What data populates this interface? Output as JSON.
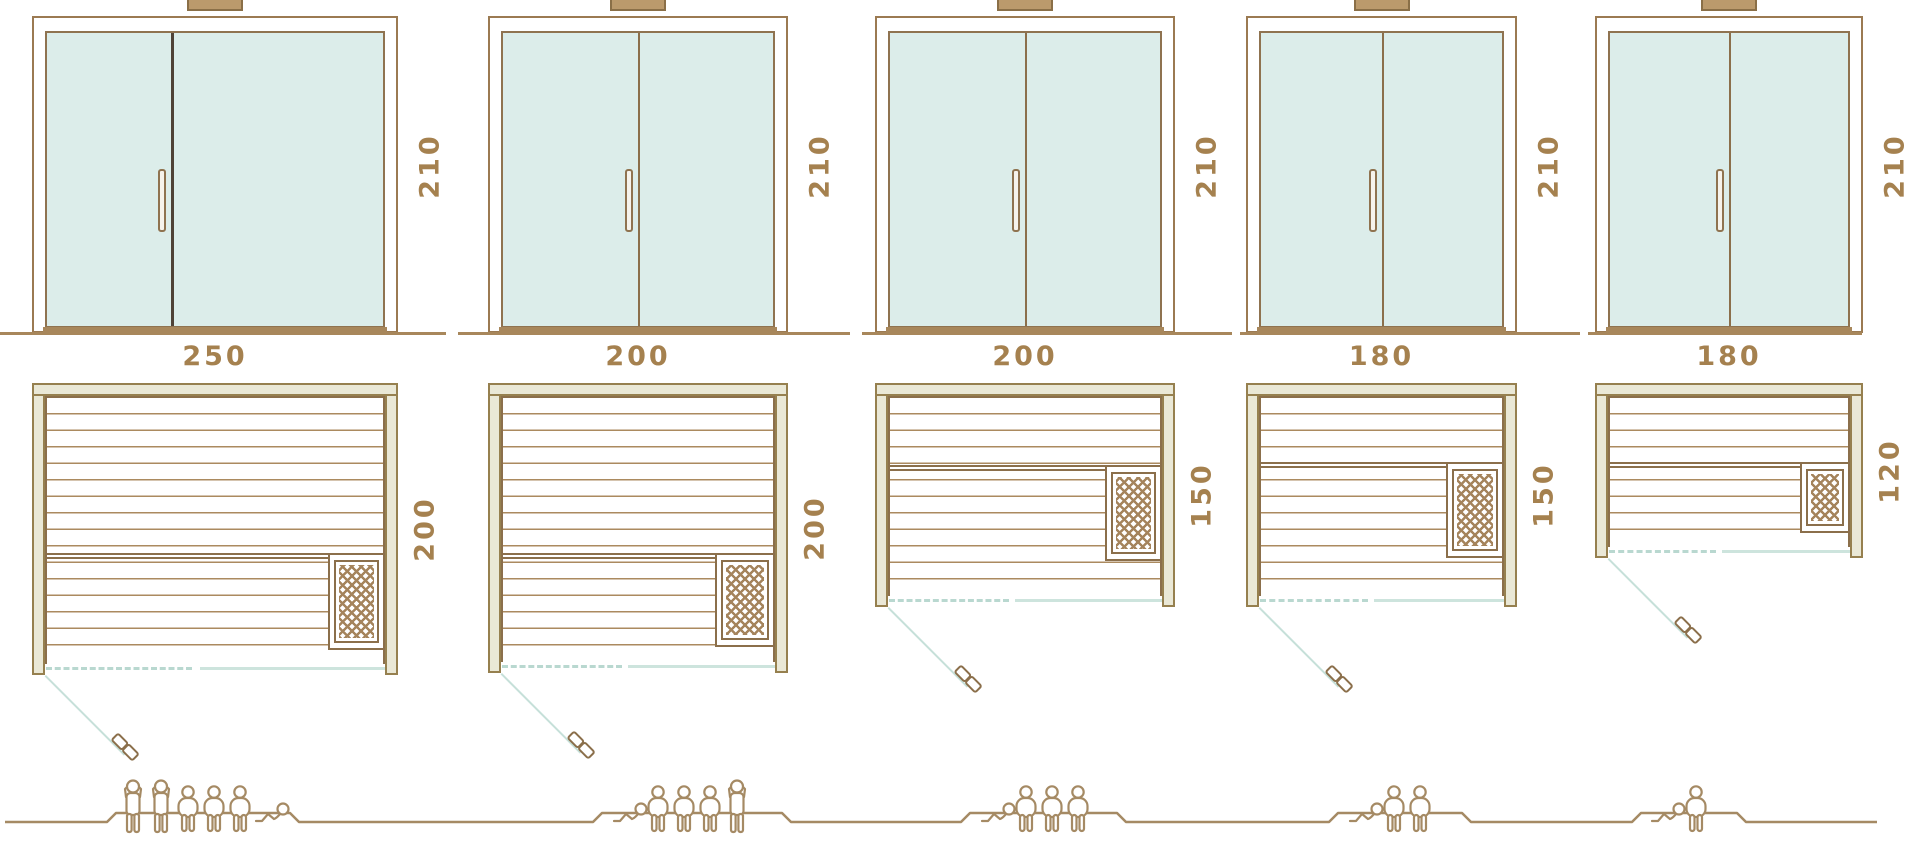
{
  "title": "Sauna model size comparison",
  "units": [
    {
      "name": "sauna-250x200",
      "door_height_label": "210",
      "width_label": "250",
      "depth_label": "200",
      "capacity_figures": [
        "standing-person",
        "standing-person",
        "seated-person",
        "seated-person",
        "seated-person",
        "reclining-person"
      ]
    },
    {
      "name": "sauna-200x200",
      "door_height_label": "210",
      "width_label": "200",
      "depth_label": "200",
      "capacity_figures": [
        "reclining-person",
        "seated-person",
        "seated-person",
        "seated-person",
        "standing-person"
      ]
    },
    {
      "name": "sauna-200x150",
      "door_height_label": "210",
      "width_label": "200",
      "depth_label": "150",
      "capacity_figures": [
        "reclining-person",
        "seated-person",
        "seated-person",
        "seated-person"
      ]
    },
    {
      "name": "sauna-180x150",
      "door_height_label": "210",
      "width_label": "180",
      "depth_label": "150",
      "capacity_figures": [
        "reclining-person",
        "seated-person",
        "seated-person"
      ]
    },
    {
      "name": "sauna-180x120",
      "door_height_label": "210",
      "width_label": "180",
      "depth_label": "120",
      "capacity_figures": [
        "reclining-person",
        "seated-person"
      ]
    }
  ],
  "colors": {
    "outline_brown": "#9b7a52",
    "dark_divider": "#4f4337",
    "wall_fill": "#eae8d6",
    "glass_mint": "#dcedea",
    "teal_line": "#c6e0d9",
    "label_text": "#a5814f",
    "figure_brown": "#a58a64",
    "wood_line": "#ab8a5f",
    "ground_brown": "#a8875b"
  }
}
